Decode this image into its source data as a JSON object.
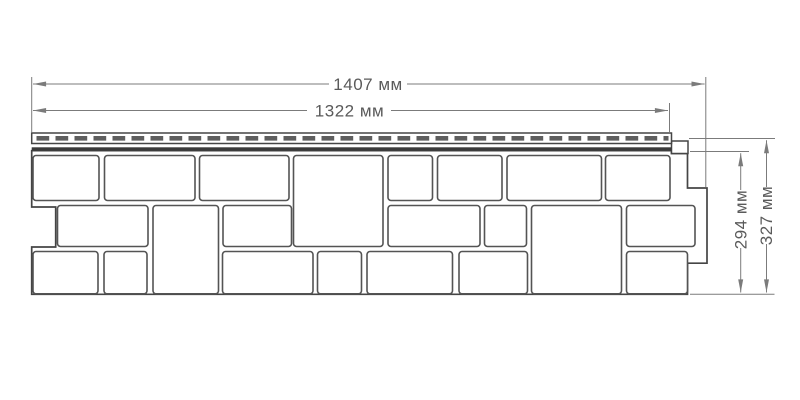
{
  "diagram": {
    "units": "мм",
    "dimensions": {
      "total_width": "1407 мм",
      "panel_width": "1322 мм",
      "panel_height": "294 мм",
      "total_height": "327 мм"
    }
  },
  "colors": {
    "background": "#ffffff",
    "outline": "#454545",
    "block_outline": "#545454",
    "dash": "#5e5e5e",
    "dimension_line": "#7b7b7b",
    "dimension_text": "#5a5a5a",
    "hem": "#3a3a3a"
  }
}
